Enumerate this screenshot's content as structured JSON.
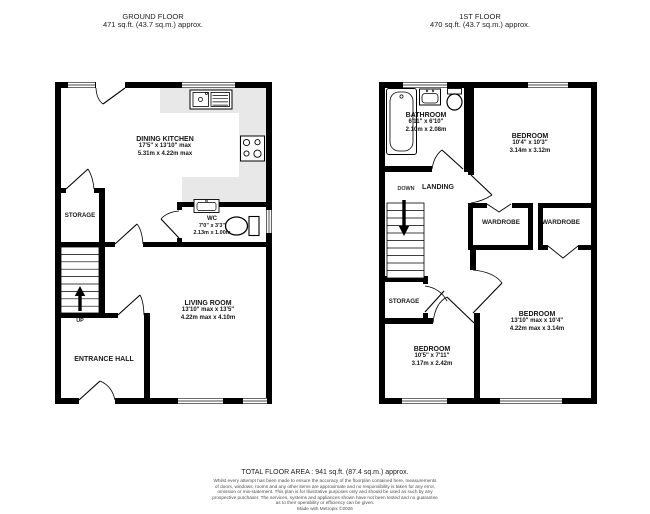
{
  "ground_floor": {
    "title": "GROUND FLOOR",
    "area": "471 sq.ft. (43.7 sq.m.) approx.",
    "rooms": {
      "dining_kitchen": {
        "name": "DINING KITCHEN",
        "imperial": "17'5\" x 13'10\" max",
        "metric": "5.31m x 4.22m max"
      },
      "storage": {
        "name": "STORAGE"
      },
      "wc": {
        "name": "WC",
        "imperial": "7'0\" x 3'3\"",
        "metric": "2.13m x 1.00m"
      },
      "living_room": {
        "name": "LIVING ROOM",
        "imperial": "13'10\" max x 13'5\"",
        "metric": "4.22m max x 4.10m"
      },
      "entrance_hall": {
        "name": "ENTRANCE HALL"
      }
    },
    "stairs_label": "UP"
  },
  "first_floor": {
    "title": "1ST FLOOR",
    "area": "470 sq.ft. (43.7 sq.m.) approx.",
    "rooms": {
      "bathroom": {
        "name": "BATHROOM",
        "imperial": "6'11\" x 6'10\"",
        "metric": "2.10m x 2.08m"
      },
      "bedroom_1": {
        "name": "BEDROOM",
        "imperial": "10'4\" x 10'3\"",
        "metric": "3.14m x 3.12m"
      },
      "landing": {
        "name": "LANDING"
      },
      "wardrobe_1": {
        "name": "WARDROBE"
      },
      "wardrobe_2": {
        "name": "WARDROBE"
      },
      "storage": {
        "name": "STORAGE"
      },
      "bedroom_2": {
        "name": "BEDROOM",
        "imperial": "10'5\" x 7'11\"",
        "metric": "3.17m x 2.42m"
      },
      "bedroom_3": {
        "name": "BEDROOM",
        "imperial": "13'10\" max x 10'4\"",
        "metric": "4.22m max x 3.14m"
      }
    },
    "stairs_label": "DOWN"
  },
  "footer": {
    "total_area": "TOTAL FLOOR AREA : 941 sq.ft. (87.4 sq.m.) approx.",
    "disclaimer_lines": [
      "Whilst every attempt has been made to ensure the accuracy of the floorplan contained here, measurements",
      "of doors, windows, rooms and any other items are approximate and no responsibility is taken for any error,",
      "omission or mis-statement. This plan is for illustrative purposes only and should be used as such by any",
      "prospective purchaser. The services, systems and appliances shown have not been tested and no guarantee",
      "as to their operability or efficiency can be given."
    ],
    "made_with": "Made with Metropix ©2026"
  },
  "colors": {
    "wall": "#000000",
    "counter": "#e8e8e8",
    "text": "#141414",
    "disclaimer": "#4d4d4d"
  }
}
